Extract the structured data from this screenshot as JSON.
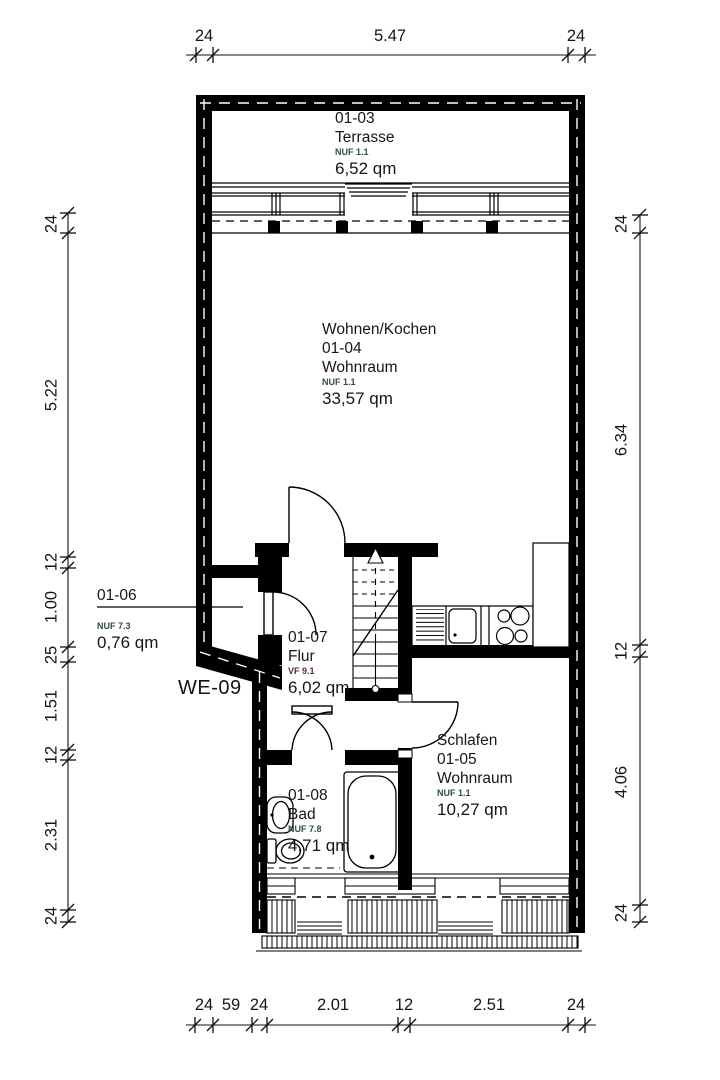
{
  "unit": {
    "label": "WE-09"
  },
  "rooms": {
    "terrasse": {
      "id": "01-03",
      "name": "Terrasse",
      "zone": "NUF 1.1",
      "area": "6,52 qm"
    },
    "wohnen": {
      "title": "Wohnen/Kochen",
      "id": "01-04",
      "name": "Wohnraum",
      "zone": "NUF 1.1",
      "area": "33,57 qm"
    },
    "abstell": {
      "id": "01-06",
      "zone": "NUF 7.3",
      "area": "0,76 qm"
    },
    "flur": {
      "id": "01-07",
      "name": "Flur",
      "zone": "VF 9.1",
      "area": "6,02 qm"
    },
    "schlafen": {
      "title": "Schlafen",
      "id": "01-05",
      "name": "Wohnraum",
      "zone": "NUF 1.1",
      "area": "10,27 qm"
    },
    "bad": {
      "id": "01-08",
      "name": "Bad",
      "zone": "NUF 7.8",
      "area": "4,71 qm"
    }
  },
  "dimensions": {
    "top": [
      "24",
      "5.47",
      "24"
    ],
    "bottom": [
      "24",
      "59",
      "24",
      "2.01",
      "12",
      "2.51",
      "24"
    ],
    "left": [
      "24",
      "5.22",
      "12",
      "1.00",
      "25",
      "1.51",
      "12",
      "2.31",
      "24"
    ],
    "right": [
      "24",
      "6.34",
      "12",
      "4.06",
      "24"
    ]
  },
  "colors": {
    "wall": "#000000",
    "zone_nuf": "#2e4f3e",
    "zone_vf": "#5a2f2f",
    "text": "#161616"
  }
}
